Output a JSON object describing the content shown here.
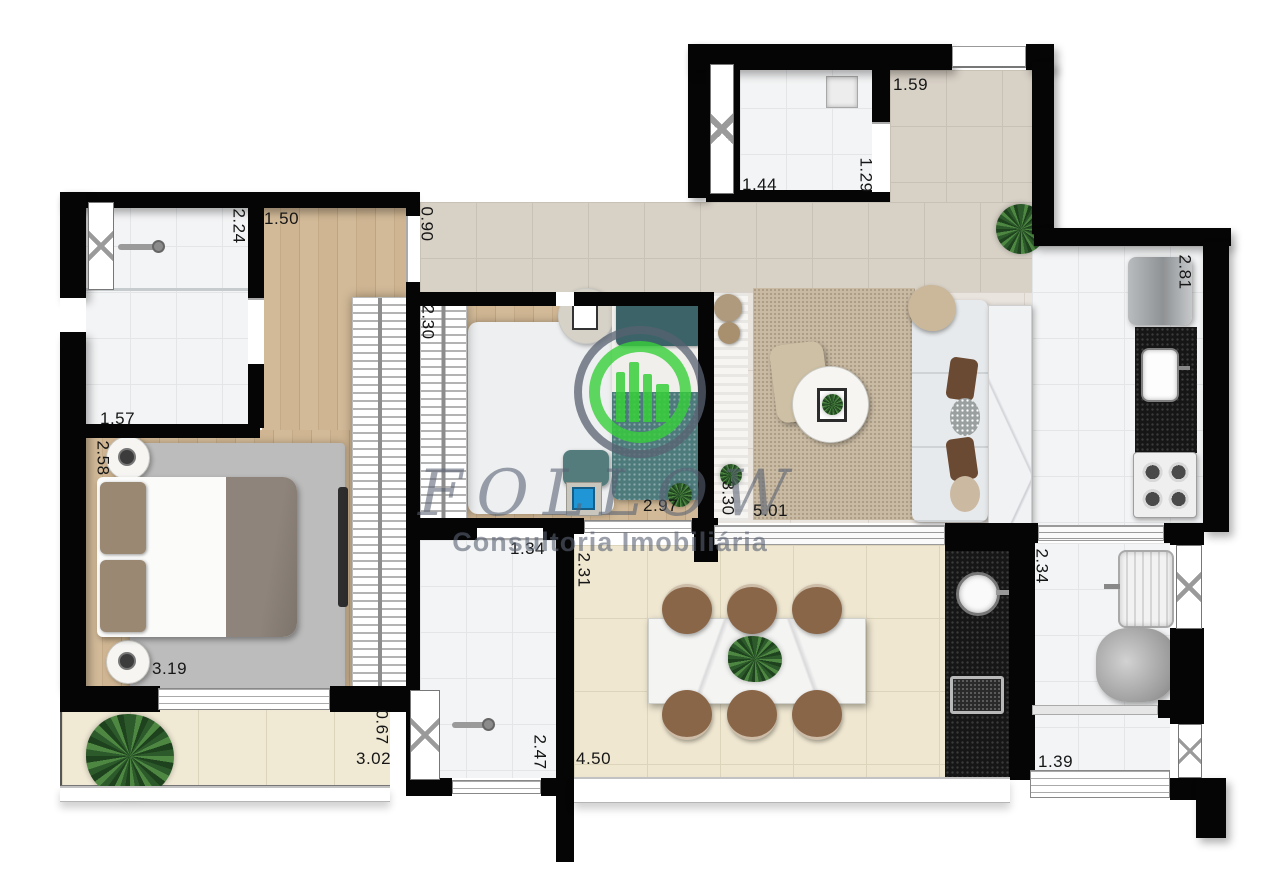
{
  "watermark": {
    "brand": "FOLLOW",
    "subtitle": "Consultoria Imobiliária",
    "logo": "green-buildings-in-double-circle",
    "accent_green": "#37cf3a",
    "mark_gray": "#5f6672"
  },
  "dimensions": {
    "closet_width": "1.50",
    "suite_bath_depth": "2.24",
    "suite_bath_width": "1.57",
    "suite_depth": "2.58",
    "suite_width": "3.19",
    "closet_door_width": "0.90",
    "bedroom2_wardrobe_depth": "2.30",
    "bedroom2_width": "2.97",
    "living_opening_depth": "3.30",
    "living_width": "5.01",
    "lavabo_width": "1.44",
    "lavabo_depth": "1.29",
    "entry_hall_width": "1.59",
    "kitchen_depth": "2.81",
    "bath2_width": "1.34",
    "bath2_depth": "2.47",
    "gourmet_depth": "2.31",
    "gourmet_width": "4.50",
    "balcony_depth": "0.67",
    "balcony_width": "3.02",
    "laundry_depth": "2.34",
    "laundry_width": "1.39"
  },
  "colors": {
    "wall": "#050505",
    "wood_floor": "#cdb493",
    "hall_tile": "#d8d1c6",
    "terrace_tile": "#efe7d0",
    "living_rug": "#c8baa3",
    "teal_bedding": "#4d7b7c",
    "black_granite": "#161616",
    "dining_chair_brown": "#8a6648"
  }
}
